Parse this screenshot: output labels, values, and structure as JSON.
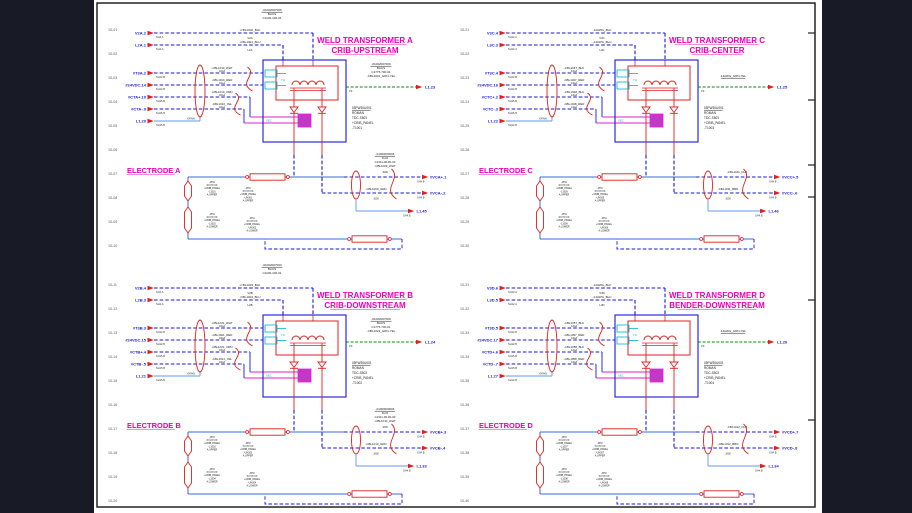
{
  "colors": {
    "blue": "#1818dd",
    "light_blue": "#5d9ae8",
    "solid_blue": "#3a6ae0",
    "red": "#e02020",
    "magenta": "#dd22cc",
    "title": "#ee00b8",
    "cyan": "#00b4c8",
    "green": "#0a8a0a",
    "muted": "#555555",
    "text": "#1a1a1a",
    "bg": "#181b25",
    "sheet": "#ffffff",
    "frame": "#222222"
  },
  "quadrants": [
    {
      "id": "A",
      "title1": "WELD TRANSFORMER A",
      "title2": "CRIB-UPSTREAM",
      "electrode_title": "ELECTRODE A",
      "line_numbers": [
        "10-01",
        "10-02",
        "10-03",
        "10-04",
        "10-05",
        "10-06",
        "10-07",
        "10-08",
        "10-09",
        "10-10"
      ],
      "top_block": [
        "-01002007000",
        "BAUS",
        "C1100-100-01"
      ],
      "top_wires": [
        {
          "name": "V2A.2",
          "ref": "SH4.A",
          "cable": "-CBL1002_BLK",
          "sub": "V2A"
        },
        {
          "name": "L2A.1",
          "ref": "SH4.A",
          "cable": "-CBL1001_BLU",
          "sub": "L2A"
        }
      ],
      "mid_wires": [
        {
          "name": "#T3A.2",
          "ref": "SH12.B",
          "cable": "-CBL1010_WHT",
          "gauge": "10GA"
        },
        {
          "name": "#24VDC.14",
          "ref": "SH12.B",
          "cable": "-CBL1010_RED",
          "gauge": "10GA"
        },
        {
          "name": "#CTA+.10",
          "ref": "SH15.B",
          "cable": "-CBL1010_ORN",
          "gauge": "10GA"
        },
        {
          "name": "#CTA-.9",
          "ref": "SH15.B",
          "cable": "-CBL1010_YEL",
          "gauge": "10GA"
        }
      ],
      "aux_in": {
        "name": "L1.20",
        "ref": "SH15.B"
      },
      "drain_label": "-DRAIN",
      "pe_block": [
        "-01002007009",
        "BAUS",
        "C1775-700-01",
        "-CBL1001_GRN-YEL"
      ],
      "pe_label": "PE",
      "pe_exit": "L1.23",
      "xfmr_block": [
        "05FW30U001",
        "ROMAN",
        "TDC-S503",
        "+CRIB_PANEL",
        "-T1001"
      ],
      "th": "TH",
      "sec": "SEC.",
      "exit_block": [
        "-01000000006",
        "KLIO",
        "C1311-00-00-00",
        "-CBL1009_WHT"
      ],
      "exit_wires": [
        {
          "name": "#VCA+.1",
          "ref": "SH4.B",
          "cable": "-CBL1009_WHT",
          "gauge": "1000"
        },
        {
          "name": "#VCA-.2",
          "ref": "SH4.B",
          "cable": "-CBL1009_GRN",
          "gauge": "1000"
        }
      ],
      "aux_out": {
        "name": "L1.45",
        "ref": "SH4.B"
      },
      "lug_labels": [
        [
          "ATM",
          "XX:XX:XX",
          "+CRIB_PANEL",
          "-L1001",
          "A:UPPER"
        ],
        [
          "ATM",
          "XX:XX:XX",
          "+CRIB_PANEL",
          "-L1002",
          "A:LOWER"
        ]
      ],
      "shunt_labels": [
        [
          "ATM",
          "XX:XX:XX",
          "+CRIB_PANEL",
          "-UH001",
          "A:UPPER"
        ],
        [
          "ATM",
          "XX:XX:XX",
          "+CRIB_PANEL",
          "-UH002",
          "A:LOWER"
        ]
      ]
    },
    {
      "id": "C",
      "title1": "WELD TRANSFORMER C",
      "title2": "CRIB-CENTER",
      "electrode_title": "ELECTRODE C",
      "line_numbers": [
        "10-21",
        "10-22",
        "10-23",
        "10-24",
        "10-25",
        "10-26",
        "10-27",
        "10-28",
        "10-29",
        "10-30"
      ],
      "top_block": null,
      "top_wires": [
        {
          "name": "V3C.4",
          "ref": "SH12.A",
          "cable": "-14AWG_BLK",
          "sub": "V3C"
        },
        {
          "name": "L3C.3",
          "ref": "SH12.A",
          "cable": "-14AWG_BLU",
          "sub": "L3C"
        }
      ],
      "mid_wires": [
        {
          "name": "#T3C.4",
          "ref": "SH12.B",
          "cable": "-CBL1047_BLK",
          "gauge": "14GA"
        },
        {
          "name": "#24VDC.16",
          "ref": "SH12.B",
          "cable": "-CBL1047_RED",
          "gauge": "14GA"
        },
        {
          "name": "#CTC+.2",
          "ref": "SH15.B",
          "cable": "-CBL1048_BLK",
          "gauge": "14GA"
        },
        {
          "name": "#CTC-.3",
          "ref": "SH15.B",
          "cable": "-CBL1048_RED",
          "gauge": "14GA"
        }
      ],
      "aux_in": {
        "name": "L1.22",
        "ref": "SH12.B"
      },
      "drain_label": "-DRAIN",
      "pe_block": [
        "-14AWG_GRN-YEL"
      ],
      "pe_label": "PE",
      "pe_exit": "L1.25",
      "xfmr_block": [
        "05FW30U001",
        "ROMAN",
        "TDC-S503",
        "+CRIB_PANEL",
        "-T1003"
      ],
      "th": "TH",
      "sec": "SEC.",
      "exit_block": null,
      "exit_wires": [
        {
          "name": "#VCC+.5",
          "ref": "SH4.B",
          "cable": "-CBL1011_CLR",
          "gauge": "1000"
        },
        {
          "name": "#VCC-.6",
          "ref": "SH4.B",
          "cable": "-CBL1011_BRN",
          "gauge": "1000"
        }
      ],
      "aux_out": {
        "name": "L1.46",
        "ref": "SH4.B"
      },
      "lug_labels": [
        [
          "ATM",
          "XX:XX:XX",
          "+CRIB_PANEL",
          "-L1005",
          "A:UPPER"
        ],
        [
          "ATM",
          "XX:XX:XX",
          "+CRIB_PANEL",
          "-L1006",
          "A:LOWER"
        ]
      ],
      "shunt_labels": [
        [
          "ATM",
          "XX:XX:XX",
          "+CRIB_PANEL",
          "-UH005",
          "A:UPPER"
        ],
        [
          "ATM",
          "XX:XX:XX",
          "+CRIB_PANEL",
          "-UH006",
          "A:LOWER"
        ]
      ]
    },
    {
      "id": "B",
      "title1": "WELD TRANSFORMER B",
      "title2": "CRIB-DOWNSTREAM",
      "electrode_title": "ELECTRODE B",
      "line_numbers": [
        "10-11",
        "10-12",
        "10-13",
        "10-14",
        "10-15",
        "10-16",
        "10-17",
        "10-18",
        "10-19",
        "10-20"
      ],
      "top_block": [
        "-01002007000",
        "BAUS",
        "C1100-100-01"
      ],
      "top_wires": [
        {
          "name": "V2B.4",
          "ref": "SH4.A",
          "cable": "-CBL1003_BLK",
          "sub": "V2B"
        },
        {
          "name": "L2B.3",
          "ref": "SH4.A",
          "cable": "-CBL1004_BLU",
          "sub": "L2B"
        }
      ],
      "mid_wires": [
        {
          "name": "#T3B.3",
          "ref": "SH12.B",
          "cable": "-CBL1021_WHT",
          "gauge": "10GA"
        },
        {
          "name": "#24VDC.15",
          "ref": "SH12.B",
          "cable": "-CBL1021_RED",
          "gauge": "10GA"
        },
        {
          "name": "#CTB+.4",
          "ref": "SH15.B",
          "cable": "-CBL1021_ORN",
          "gauge": "10GA"
        },
        {
          "name": "#CTB-.5",
          "ref": "SH15.B",
          "cable": "-CBL1021_YEL",
          "gauge": "10GA"
        }
      ],
      "aux_in": {
        "name": "L1.21",
        "ref": "SH15.B"
      },
      "drain_label": "-DRAIN",
      "pe_block": [
        "-01002007009",
        "BAUS",
        "C1775-700-01",
        "-CBL1022_GRN-YEL"
      ],
      "pe_label": "PE",
      "pe_exit": "L1.24",
      "xfmr_block": [
        "05FW30U001",
        "ROMAN",
        "TDC-S503",
        "+CRIB_PANEL",
        "-T1002"
      ],
      "th": "TH",
      "sec": "SEC.",
      "exit_block": [
        "-01000000006",
        "KLIO",
        "C1311-00-00-00",
        "-CBL1010_WHT"
      ],
      "exit_wires": [
        {
          "name": "#VCB+.3",
          "ref": "SH4.B",
          "cable": "-CBL1010_WHT",
          "gauge": "1000"
        },
        {
          "name": "#VCB-.4",
          "ref": "SH4.B",
          "cable": "-CBL1010_GRN",
          "gauge": "1000"
        }
      ],
      "aux_out": {
        "name": "L1.33",
        "ref": "SH4.B"
      },
      "lug_labels": [
        [
          "ATM",
          "XX:XX:XX",
          "+CRIB_PANEL",
          "-L1003",
          "A:UPPER"
        ],
        [
          "ATM",
          "XX:XX:XX",
          "+CRIB_PANEL",
          "-L1004",
          "A:LOWER"
        ]
      ],
      "shunt_labels": [
        [
          "ATM",
          "XX:XX:XX",
          "+CRIB_PANEL",
          "-UH003",
          "A:UPPER"
        ],
        [
          "ATM",
          "XX:XX:XX",
          "+CRIB_PANEL",
          "-UH004",
          "A:LOWER"
        ]
      ]
    },
    {
      "id": "D",
      "title1": "WELD TRANSFORMER D",
      "title2": "BENDER-DOWNSTREAM",
      "electrode_title": "ELECTRODE D",
      "line_numbers": [
        "10-31",
        "10-32",
        "10-33",
        "10-34",
        "10-35",
        "10-36",
        "10-37",
        "10-38",
        "10-39",
        "10-40"
      ],
      "top_block": null,
      "top_wires": [
        {
          "name": "V3D.6",
          "ref": "SH12.A",
          "cable": "-14AWG_BLK",
          "sub": "V3D"
        },
        {
          "name": "L3D.5",
          "ref": "SH12.A",
          "cable": "-14AWG_BLU",
          "sub": "L3D"
        }
      ],
      "mid_wires": [
        {
          "name": "#T3D.5",
          "ref": "SH12.B",
          "cable": "-CBL1057_BLK",
          "gauge": "14GA"
        },
        {
          "name": "#24VDC.17",
          "ref": "SH12.B",
          "cable": "-CBL1057_RED",
          "gauge": "14GA"
        },
        {
          "name": "#CTD+.6",
          "ref": "SH15.B",
          "cable": "-CBL1058_BLK",
          "gauge": "14GA"
        },
        {
          "name": "#CTD-.7",
          "ref": "SH15.B",
          "cable": "-CBL1058_RED",
          "gauge": "14GA"
        }
      ],
      "aux_in": {
        "name": "L1.27",
        "ref": "SH12.B"
      },
      "drain_label": "-DRAIN",
      "pe_block": [
        "-14AWG_GRN-YEL"
      ],
      "pe_label": "PE",
      "pe_exit": "L1.26",
      "xfmr_block": [
        "05FW30U001",
        "ROMAN",
        "TDC-S503",
        "+CRIB_PANEL",
        "-T1004"
      ],
      "th": "TH",
      "sec": "SEC.",
      "exit_block": null,
      "exit_wires": [
        {
          "name": "#VCD+.7",
          "ref": "SH4.B",
          "cable": "-CBL1012_CLR",
          "gauge": "1000"
        },
        {
          "name": "#VCD-.8",
          "ref": "SH4.B",
          "cable": "-CBL1012_BRN",
          "gauge": "1000"
        }
      ],
      "aux_out": {
        "name": "L1.34",
        "ref": "SH4.B"
      },
      "lug_labels": [
        [
          "ATM",
          "XX:XX:XX",
          "+CRIB_PANEL",
          "-L1007",
          "A:UPPER"
        ],
        [
          "ATM",
          "XX:XX:XX",
          "+CRIB_PANEL",
          "-L1008",
          "A:LOWER"
        ]
      ],
      "shunt_labels": [
        [
          "ATM",
          "XX:XX:XX",
          "+CRIB_PANEL",
          "-UH007",
          "A:UPPER"
        ],
        [
          "ATM",
          "XX:XX:XX",
          "+CRIB_PANEL",
          "-UH008",
          "A:LOWER"
        ]
      ]
    }
  ]
}
